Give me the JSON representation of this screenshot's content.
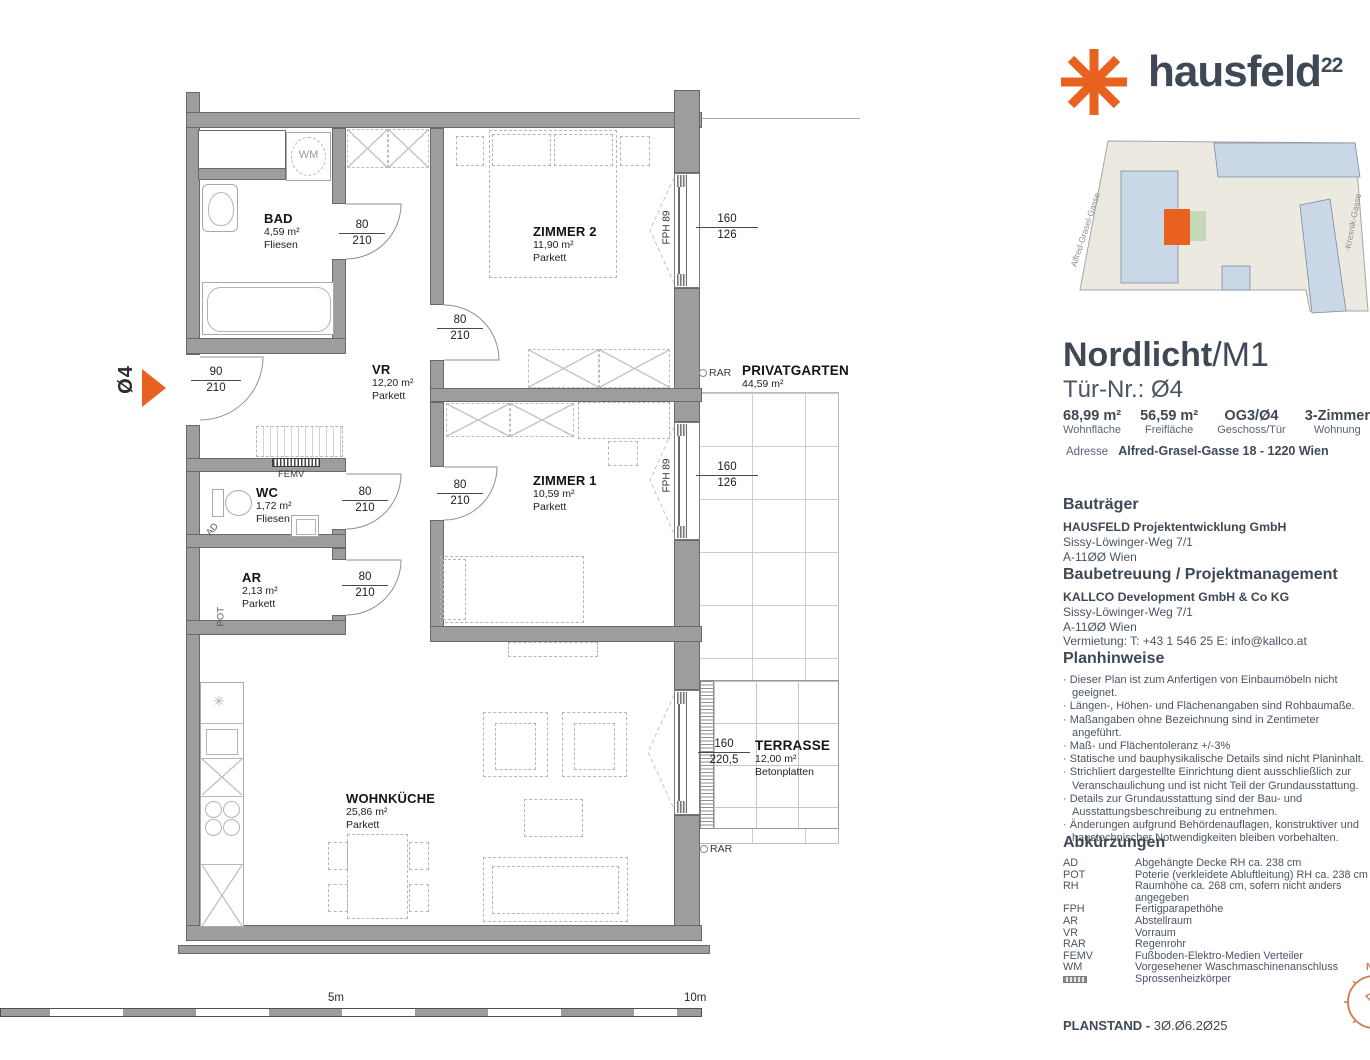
{
  "branding": {
    "name": "hausfeld",
    "sup": "22"
  },
  "site_plan": {
    "street_left": "Alfred-Grasel-Gasse",
    "street_right": "-Kresnik-Gasse",
    "compass_n": "N"
  },
  "unit": {
    "project": "Nordlicht",
    "variant": "/M1",
    "door": "Tür-Nr.: Ø4",
    "stats": [
      {
        "value": "68,99 m²",
        "label": "Wohnfläche"
      },
      {
        "value": "56,59 m²",
        "label": "Freifläche"
      },
      {
        "value": "OG3/Ø4",
        "label": "Geschoss/Tür"
      },
      {
        "value": "3-Zimmer",
        "label": "Wohnung"
      }
    ],
    "address_label": "Adresse",
    "address": "Alfred-Grasel-Gasse 18 - 1220 Wien"
  },
  "developer": {
    "heading": "Bauträger",
    "name": "HAUSFELD Projektentwicklung GmbH",
    "address1": "Sissy-Löwinger-Weg 7/1",
    "address2": "A-11ØØ Wien"
  },
  "management": {
    "heading": "Baubetreuung / Projektmanagement",
    "name": "KALLCO Development GmbH & Co KG",
    "address1": "Sissy-Löwinger-Weg 7/1",
    "address2": "A-11ØØ Wien",
    "contact": "Vermietung: T: +43 1 546 25  E: info@kallco.at"
  },
  "notes": {
    "heading": "Planhinweise",
    "items": [
      "Dieser Plan ist zum Anfertigen von Einbaumöbeln nicht geeignet.",
      "Längen-, Höhen- und Flächenangaben sind Rohbaumaße.",
      "Maßangaben ohne Bezeichnung sind in Zentimeter angeführt.",
      "Maß- und Flächentoleranz +/-3%",
      "Statische und bauphysikalische Details sind nicht Planinhalt.",
      "Strichliert dargestellte Einrichtung dient ausschließlich zur Veranschaulichung und ist nicht Teil der Grundausstattung.",
      "Details zur Grundausstattung sind der Bau- und Ausstattungsbeschreibung zu entnehmen.",
      "Änderungen aufgrund Behördenauflagen, konstruktiver und haustechnischer Notwendigkeiten bleiben vorbehalten."
    ]
  },
  "abbreviations": {
    "heading": "Abkürzungen",
    "items": [
      {
        "abbr": "AD",
        "meaning": "Abgehängte Decke RH ca. 238 cm"
      },
      {
        "abbr": "POT",
        "meaning": "Poterie (verkleidete Abluftleitung) RH ca. 238 cm"
      },
      {
        "abbr": "RH",
        "meaning": "Raumhöhe ca. 268 cm, sofern nicht anders angegeben"
      },
      {
        "abbr": "FPH",
        "meaning": "Fertigparapethöhe"
      },
      {
        "abbr": "AR",
        "meaning": "Abstellraum"
      },
      {
        "abbr": "VR",
        "meaning": "Vorraum"
      },
      {
        "abbr": "RAR",
        "meaning": "Regenrohr"
      },
      {
        "abbr": "FEMV",
        "meaning": "Fußboden-Elektro-Medien Verteiler"
      },
      {
        "abbr": "WM",
        "meaning": "Vorgesehener Waschmaschinenanschluss"
      }
    ],
    "radiator_meaning": "Sprossenheizkörper"
  },
  "footer": {
    "label": "PLANSTAND -",
    "date": "3Ø.Ø6.2Ø25"
  },
  "floor_plan": {
    "rooms": {
      "bad": {
        "name": "BAD",
        "area": "4,59 m²",
        "floor": "Fliesen"
      },
      "zimmer2": {
        "name": "ZIMMER 2",
        "area": "11,90 m²",
        "floor": "Parkett"
      },
      "vr": {
        "name": "VR",
        "area": "12,20 m²",
        "floor": "Parkett"
      },
      "wc": {
        "name": "WC",
        "area": "1,72 m²",
        "floor": "Fliesen"
      },
      "ar": {
        "name": "AR",
        "area": "2,13 m²",
        "floor": "Parkett"
      },
      "zimmer1": {
        "name": "ZIMMER 1",
        "area": "10,59 m²",
        "floor": "Parkett"
      },
      "wohnkueche": {
        "name": "WOHNKÜCHE",
        "area": "25,86 m²",
        "floor": "Parkett"
      },
      "privatgarten": {
        "name": "PRIVATGARTEN",
        "area": "44,59 m²"
      },
      "terrasse": {
        "name": "TERRASSE",
        "area": "12,00 m²",
        "floor": "Betonplatten"
      }
    },
    "dims": {
      "entrance": {
        "t": "90",
        "b": "210"
      },
      "door80": {
        "t": "80",
        "b": "210"
      },
      "window160": {
        "t": "160",
        "b": "126"
      },
      "terrace": {
        "t": "160",
        "b": "220,5"
      }
    },
    "labels": {
      "unit_marker": "Ø4",
      "wm": "WM",
      "femv": "FEMV",
      "ad": "AD",
      "pot": "POT",
      "rar": "RAR",
      "fph": "FPH 89",
      "freezer": "✳",
      "scale5": "5m",
      "scale10": "10m"
    }
  }
}
